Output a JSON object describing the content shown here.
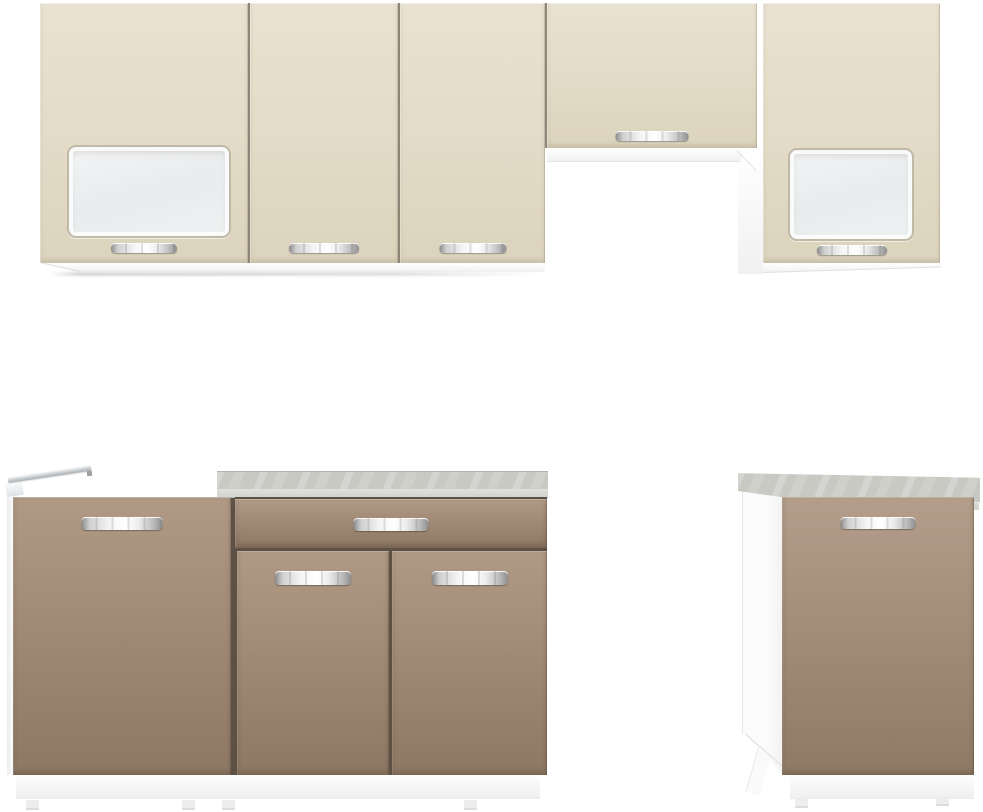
{
  "image": {
    "kind": "furniture product photo",
    "subject": "Modular kitchen cabinet set on white background",
    "background": "#ffffff"
  },
  "palette": {
    "upper_doors_cream": "#e2dac6",
    "base_doors_taupe": "#a8917e",
    "worktop_grey": "#c9cac4",
    "carcass_white": "#fbfbfb",
    "handle_chrome": "#d7d7d7",
    "frosted_glass": "#eef0f2",
    "gap_upper": "#8d8575",
    "gap_lower": "#5d5044"
  },
  "units": {
    "wall_glass_left": {
      "label": "Wall cabinet with frosted-glass door"
    },
    "wall_plain_a": {
      "label": "Wall cabinet door"
    },
    "wall_plain_b": {
      "label": "Wall cabinet door"
    },
    "wall_over_hood": {
      "label": "Short wall cabinet above extractor-hood space"
    },
    "wall_glass_right": {
      "label": "Wall cabinet with frosted-glass door"
    },
    "base_appliance": {
      "label": "Base cabinet with side rail for built-in appliance"
    },
    "base_drawer_unit": {
      "label": "Base cabinet with one drawer and two doors"
    },
    "base_single_right": {
      "label": "Free-standing base cabinet with worktop"
    },
    "worktop": {
      "label": "Grey worktop"
    },
    "glass_panel": {
      "label": "Frosted glass panel"
    },
    "handle": {
      "label": "Chrome bar handle"
    },
    "plinth": {
      "label": "White plinth with feet"
    },
    "rail": {
      "label": "Aluminium appliance rail"
    },
    "side_panel": {
      "label": "White carcass side panel"
    }
  }
}
